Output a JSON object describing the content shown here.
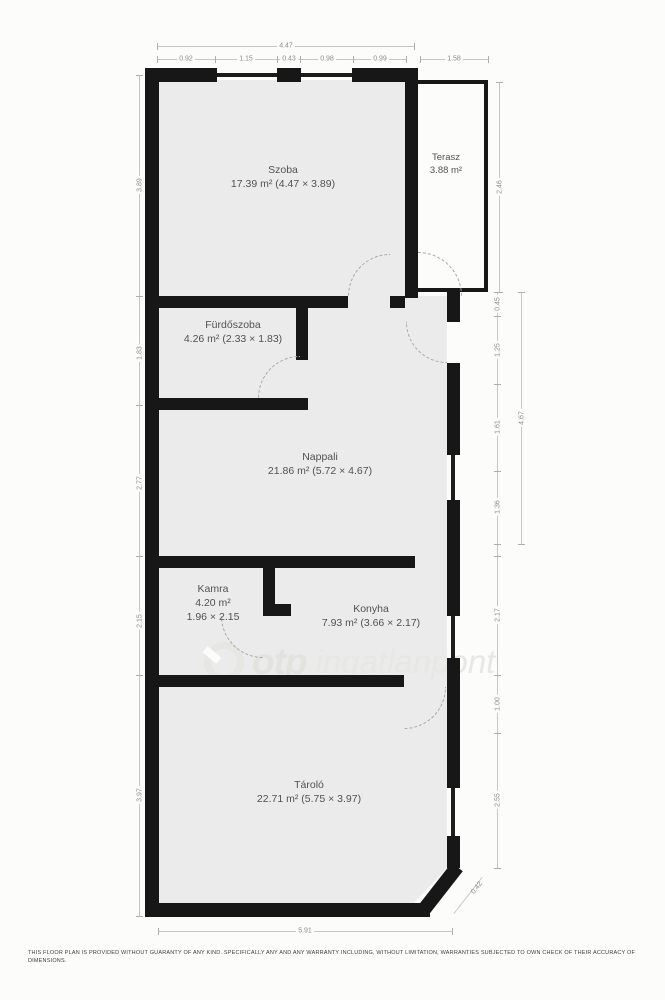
{
  "rooms": [
    {
      "name": "Szoba",
      "line2": "17.39 m² (4.47 × 3.89)",
      "line3": ""
    },
    {
      "name": "Terasz",
      "line2": "3.88 m²",
      "line3": ""
    },
    {
      "name": "Fürdőszoba",
      "line2": "4.26 m² (2.33 × 1.83)",
      "line3": ""
    },
    {
      "name": "Nappali",
      "line2": "21.86 m² (5.72 × 4.67)",
      "line3": ""
    },
    {
      "name": "Kamra",
      "line2": "4.20 m²",
      "line3": "1.96 × 2.15"
    },
    {
      "name": "Konyha",
      "line2": "7.93 m² (3.66 × 2.17)",
      "line3": ""
    },
    {
      "name": "Tároló",
      "line2": "22.71 m² (5.75 × 3.97)",
      "line3": ""
    }
  ],
  "dims": {
    "top_total": "4.47",
    "top_segments": [
      "0.92",
      "1.15",
      "0.43",
      "0.98",
      "0.99"
    ],
    "terasz_width": "1.58",
    "left": [
      "3.89",
      "1.83",
      "2.77",
      "2.15",
      "3.97"
    ],
    "terasz_height": "2.46",
    "nappali_right_segments": [
      "0.45",
      "1.25",
      "1.61",
      "1.36"
    ],
    "nappali_right_total": "4.67",
    "konyha_right": "2.17",
    "tarolo_right": [
      "1.00",
      "2.55"
    ],
    "bottom_total": "5.91",
    "chamfer": "0.42"
  },
  "watermark": {
    "brand": "otp",
    "name": "ingatlanpont"
  },
  "disclaimer": {
    "line1": "THIS FLOOR PLAN IS PROVIDED WITHOUT GUARANTY OF ANY KIND. SPECIFICALLY ANY AND ANY WARRANTY INCLUDING, WITHOUT LIMITATION, WARRANTIES SUBJECTED TO OWN CHECK OF THEIR ACCURACY OF",
    "line2": "DIMENSIONS."
  },
  "colors": {
    "wall": "#171717",
    "room_fill": "#ebebeb",
    "dimension_text": "#8c8c8c",
    "label_text": "#525252",
    "watermark": "#e2e2df",
    "background": "#fcfcfa"
  }
}
